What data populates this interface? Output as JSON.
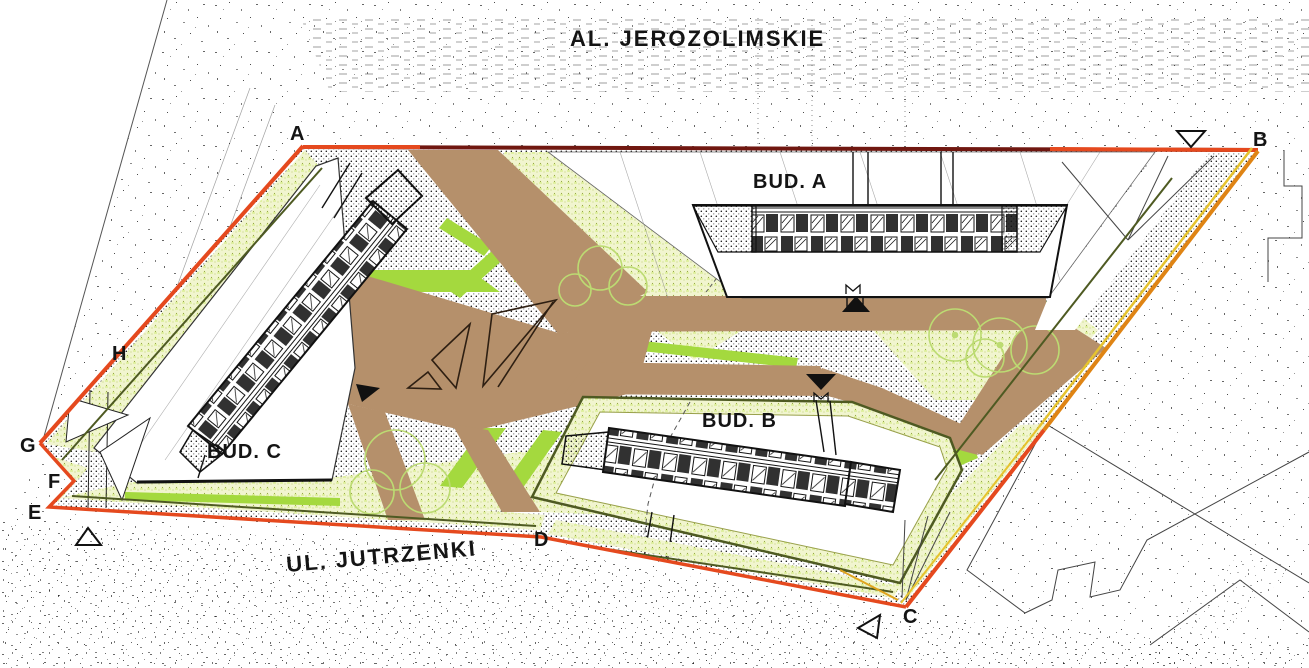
{
  "drawing": {
    "streets": {
      "top": "AL. JEROZOLIMSKIE",
      "bottom": "UL. JUTRZENKI"
    },
    "buildings": [
      {
        "label": "BUD. A"
      },
      {
        "label": "BUD. B"
      },
      {
        "label": "BUD. C"
      }
    ],
    "boundary_points": [
      "A",
      "B",
      "C",
      "D",
      "E",
      "F",
      "G",
      "H"
    ],
    "colors": {
      "boundary_red": "#E5491E",
      "boundary_dark_red": "#701710",
      "boundary_orange": "#DF8414",
      "boundary_yellow": "#E6C32E",
      "path_brown": "#B5906B",
      "grass_bright": "#A4D93E",
      "lawn_pale": "#F1F5CF",
      "olive_line": "#4E5A22",
      "tree_green": "#BCDB72",
      "ink": "#141414"
    }
  }
}
